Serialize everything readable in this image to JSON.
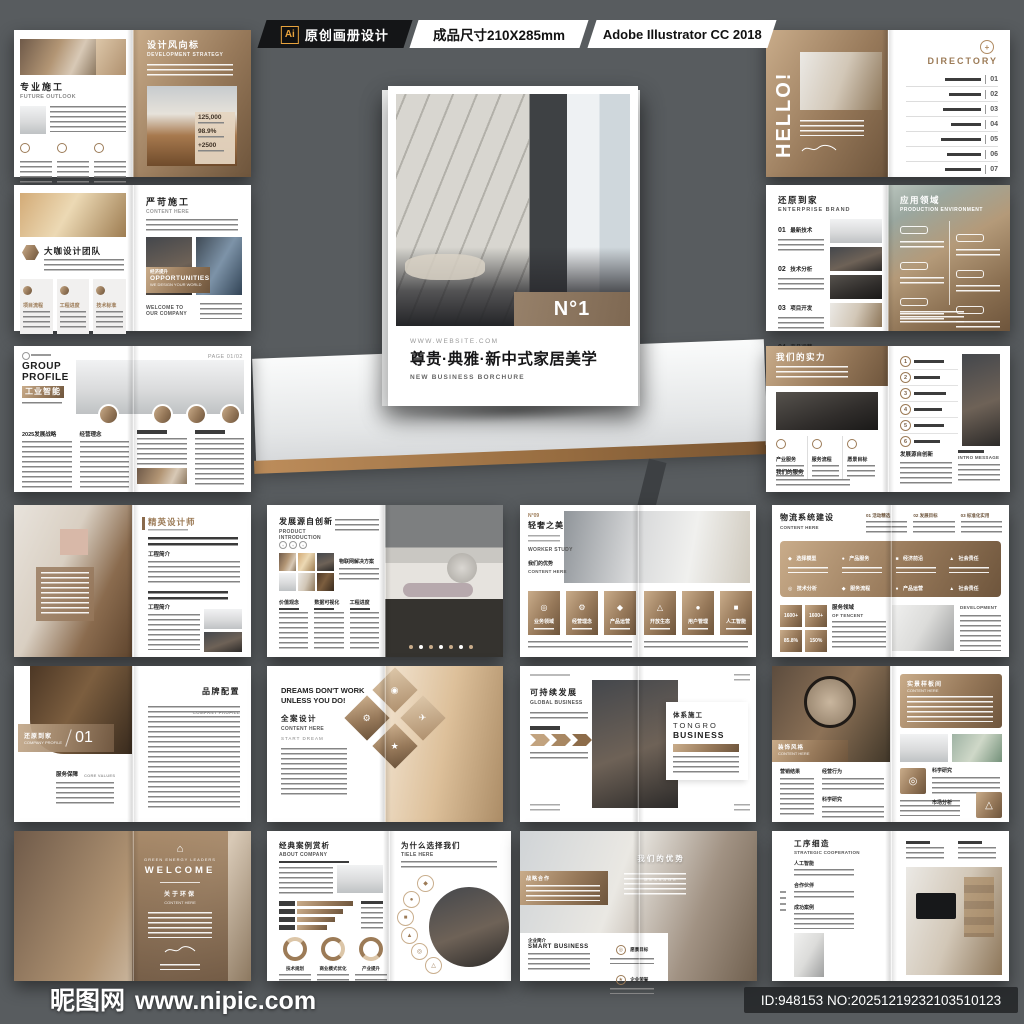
{
  "header": {
    "ai_badge": "Ai",
    "product_label": "原创画册设计",
    "size_label": "成品尺寸210X285mm",
    "software_label": "Adobe Illustrator CC 2018"
  },
  "cover": {
    "badge": "N°1",
    "website": "WWW.WEBSITE.COM",
    "title": "尊贵·典雅·新中式家居美学",
    "subtitle": "NEW BUSINESS BORCHURE"
  },
  "footer": {
    "site_name": "昵图网",
    "site_url": "www.nipic.com",
    "image_id": "ID:948153 NO:20251219232103510123"
  },
  "colors": {
    "background": "#585c5f",
    "accent_brown": "#97795a",
    "accent_brown_dark": "#6e553c",
    "accent_brown_light": "#c9ac8a",
    "ribbon_black": "#141517",
    "ai_orange": "#e8a33d"
  },
  "spreads": {
    "s1": {
      "cn_left": "专业施工",
      "en_left": "FUTURE OUTLOOK",
      "cn_right": "设计风向标",
      "en_right": "DEVELOPMENT STRATEGY",
      "stat1": "125,000",
      "stat2": "98.9%",
      "stat3": "+2500"
    },
    "s2": {
      "hello": "HELLO!",
      "directory": "DIRECTORY",
      "nums": [
        "01",
        "02",
        "03",
        "04",
        "05",
        "06",
        "07"
      ]
    },
    "s3": {
      "cn_team": "大咖设计团队",
      "col1": "项目流程",
      "col2": "工程进度",
      "col3": "技术标准",
      "cn_right": "严苛施工",
      "en_right": "CONTENT HERE",
      "opp_cn": "经济提升",
      "opp_title": "OPPORTUNITIES",
      "opp_sub": "WE DESIGN YOUR WORLD",
      "welcome": "WELCOME TO OUR COMPANY"
    },
    "s4": {
      "cn_left": "还原到家",
      "en_left": "ENTERPRISE BRAND",
      "i1": "01",
      "l1": "最新技术",
      "i2": "02",
      "l2": "技术分析",
      "i3": "03",
      "l3": "项目开发",
      "i4": "04",
      "l4": "产品运营",
      "cn_right": "应用领域",
      "en_right": "PRODUCTION ENVIRONMENT"
    },
    "s5": {
      "en1": "GROUP",
      "en2": "PROFILE",
      "cn": "工业智能",
      "page": "PAGE 01/02",
      "col1": "2025发展战略",
      "col2": "经营理念"
    },
    "s6": {
      "cn_left": "我们的实力",
      "c1": "产业服务",
      "c2": "服务流程",
      "c3": "愿景目标",
      "svc": "我们的服务",
      "n1": "1",
      "n2": "2",
      "n3": "3",
      "n4": "4",
      "n5": "5",
      "n6": "6",
      "dev": "发展源自创新",
      "intro": "INTRO MESSAGE"
    },
    "s7": {
      "cn": "精英设计师",
      "sec1": "工程简介",
      "sec2": "工程简介"
    },
    "s8": {
      "cn": "发展源自创新",
      "en": "PRODUCT INTRODUCTION",
      "iot": "物联网解决方案",
      "c1": "价值观念",
      "c2": "数据可视化",
      "c3": "工程进度"
    },
    "s9": {
      "no": "N°09",
      "cn": "轻奢之美",
      "en1": "WORKER STUDY",
      "cn2": "我们的优势",
      "en2": "CONTENT HERE",
      "cards": [
        "业务领域",
        "经营理念",
        "产品运营",
        "开放生态",
        "用户管理",
        "人工智能"
      ]
    },
    "s10": {
      "cn": "物流系统建设",
      "en": "CONTENT HERE",
      "t1": "01 活动精选",
      "t2": "02 发展目标",
      "t3": "03 标准化实用",
      "panel": [
        "选择模型",
        "社会责任",
        "技术分析",
        "服务流程",
        "产品服务",
        "经济前沿",
        "产品运营",
        "社会责任"
      ],
      "v1": "1600+",
      "v2": "1600+",
      "v3": "85.8%",
      "v4": "150%",
      "svc_cn": "服务领域",
      "svc_en": "OF TENCENT",
      "dev": "DEVELOPMENT"
    },
    "s11": {
      "banner_cn": "还原到家",
      "banner_en": "COMPANY PROFILE",
      "num": "01",
      "core_cn": "服务保障",
      "core_en": "CORE VALUES",
      "right_cn": "品牌配置",
      "right_en": "COMPANY PROFILE"
    },
    "s12": {
      "line1": "DREAMS DON'T WORK",
      "line2": "UNLESS YOU DO!",
      "cn": "全案设计",
      "en": "CONTENT HERE",
      "start": "START DREAM"
    },
    "s13": {
      "cn": "可持续发展",
      "en": "GLOBAL BUSINESS",
      "card_cn": "体系施工",
      "brand1": "TONGRO",
      "brand2": "BUSINESS"
    },
    "s14": {
      "banner_cn": "装饰风格",
      "banner_en": "CONTENT HERE",
      "c1": "营销结果",
      "c2": "经营行为",
      "c3": "科学研究",
      "panel_cn": "实景样板间",
      "panel_en": "CONTENT HERE",
      "sci": "科学研究",
      "market": "市场分析"
    },
    "s15": {
      "tag": "GREEN ENERGY LEADERS",
      "welcome": "WELCOME",
      "cn": "关于环保",
      "en": "CONTENT HERE"
    },
    "s16": {
      "cn": "经典案例赏析",
      "en": "ABOUT COMPANY",
      "d1": "技术规划",
      "d2": "商业模式优化",
      "d3": "产业提升",
      "cn_right": "为什么选择我们",
      "en_right": "TIELE HERE"
    },
    "s17": {
      "coop": "战略合作",
      "adv_cn": "我们的优势",
      "adv_en": "MESSAGE",
      "intro_cn": "企业简介",
      "smart": "SMART BUSINESS",
      "vision": "愿景目标",
      "honor": "企业荣誉"
    },
    "s18": {
      "cn": "工序细造",
      "en": "STRATEGIC COOPERATION",
      "s1": "人工智能",
      "s2": "合作伙伴",
      "s3": "成功案例"
    }
  }
}
